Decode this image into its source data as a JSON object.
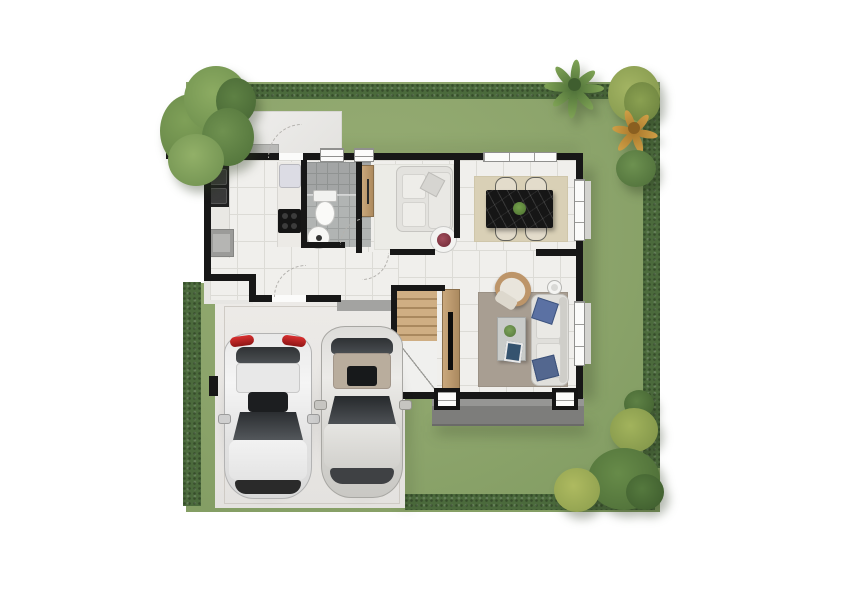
{
  "meta": {
    "title": "Top-down 3D rendered floor plan of a single-storey house with garden and carport",
    "canvas": {
      "width": 842,
      "height": 595
    }
  },
  "palette": {
    "background": "#ffffff",
    "lawn": "#8ca46b",
    "hedge": "#4b6a3c",
    "wall": "#171717",
    "floor_tile": "#f0efec",
    "bathroom_tile": "#b1b4b3",
    "wood": "#c2a077",
    "rug_living": "#a89e92",
    "rug_dining": "#d9d0b6",
    "rug_sitting": "#ecece7",
    "concrete": "#e9e8e5",
    "porch": "#7d7d7b",
    "tail_light_red": "#c22626",
    "pillow_blue": "#53678f"
  },
  "garden": {
    "lawn": {
      "label": "Garden lawn"
    },
    "hedges": [
      {
        "label": "Top boundary hedge"
      },
      {
        "label": "Right boundary hedge"
      },
      {
        "label": "Bottom boundary hedge"
      },
      {
        "label": "Left hedge strip beside carport"
      }
    ],
    "trees": [
      {
        "label": "Large tree, northwest corner"
      },
      {
        "label": "Palm tree, northeast"
      },
      {
        "label": "Shrub cluster with orange fan palm, northeast corner"
      },
      {
        "label": "Shrub cluster, southeast corner"
      }
    ],
    "gate_post": {
      "label": "Black fence post on left boundary"
    }
  },
  "house": {
    "rooms": [
      {
        "id": "kitchen",
        "label": "Kitchen",
        "features": [
          "black sink counter",
          "cooktop",
          "refrigerator",
          "washing machine"
        ]
      },
      {
        "id": "bathroom",
        "label": "Bathroom",
        "features": [
          "toilet",
          "round basin",
          "shower corner"
        ]
      },
      {
        "id": "hallway",
        "label": "Entry hall",
        "features": [
          "front door with step",
          "door swing arcs"
        ]
      },
      {
        "id": "sitting-room",
        "label": "Sitting room",
        "features": [
          "white loveseat",
          "wooden wardrobe",
          "round side table with red flowers"
        ]
      },
      {
        "id": "dining-room",
        "label": "Dining room",
        "features": [
          "black marble dining table",
          "four cream chairs",
          "beige rug",
          "green plant centerpiece"
        ]
      },
      {
        "id": "living-room",
        "label": "Living room",
        "features": [
          "white sofa with blue pillows",
          "rattan armchair",
          "coffee table with tablet and plant",
          "wooden TV cabinet",
          "floor lamp",
          "taupe rug"
        ]
      },
      {
        "id": "staircase",
        "label": "Staircase with under-stair storage"
      },
      {
        "id": "rear-patio",
        "label": "Rear patio with back door"
      },
      {
        "id": "terrace",
        "label": "Rear terrace porch"
      },
      {
        "id": "carport",
        "label": "Two-bay carport driveway"
      }
    ]
  },
  "vehicles": [
    {
      "id": "car-left",
      "label": "White SUV with red tail lights"
    },
    {
      "id": "car-right",
      "label": "Silver SUV with warm grey roof"
    }
  ]
}
